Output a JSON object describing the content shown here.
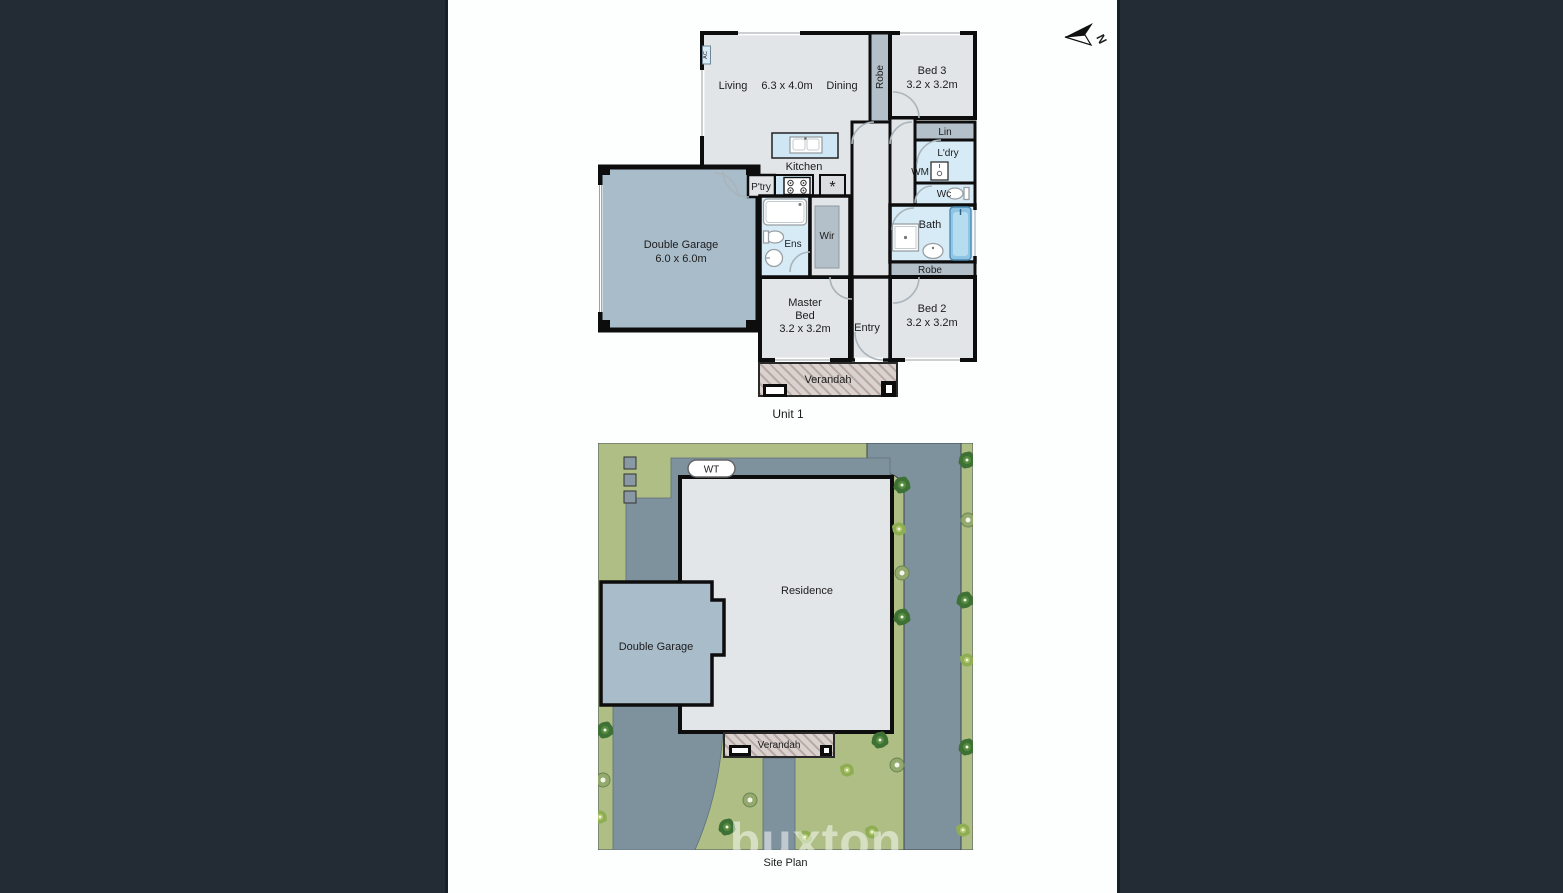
{
  "colors": {
    "bars": "#232b34",
    "canvas": "#fdfefe",
    "wall": "#0d0d0d",
    "text": "#1c1c1c",
    "room": "#e2e5e8",
    "wet": "#d7ebf7",
    "bench": "#cfe7f5",
    "robe": "#b3c0c9",
    "garage": "#a9bcca",
    "fridge": "#d9dde0",
    "hatchbg": "#d9d2cf",
    "hatchline": "#b9a9a5",
    "tub": "#8ec4e4",
    "green": "#aebe85",
    "road": "#7e929e",
    "residence": "#e3e6e9",
    "treedark": "#3e7135",
    "treemid": "#568c3f",
    "treelight": "#8fae53"
  },
  "compass": {
    "label": "N"
  },
  "unit1": {
    "title": "Unit 1",
    "living": "Living",
    "living_dim": "6.3 x 4.0m",
    "dining": "Dining",
    "robe1": "Robe",
    "bed3": "Bed 3",
    "bed3_dim": "3.2 x 3.2m",
    "lin": "Lin",
    "ldry": "L'dry",
    "wm": "WM",
    "wc": "Wc",
    "bath": "Bath",
    "robe2": "Robe",
    "bed2": "Bed 2",
    "bed2_dim": "3.2 x 3.2m",
    "entry": "Entry",
    "master_line1": "Master",
    "master_line2": "Bed",
    "master_dim": "3.2 x 3.2m",
    "ens": "Ens",
    "wir": "Wir",
    "kitchen": "Kitchen",
    "ptry": "P'try",
    "fridge_icon": "*",
    "garage": "Double Garage",
    "garage_dim": "6.0 x 6.0m",
    "verandah": "Verandah",
    "ac": "AC"
  },
  "site": {
    "title": "Site Plan",
    "residence": "Residence",
    "garage": "Double Garage",
    "verandah": "Verandah",
    "wt": "WT"
  },
  "watermark": "buxton"
}
